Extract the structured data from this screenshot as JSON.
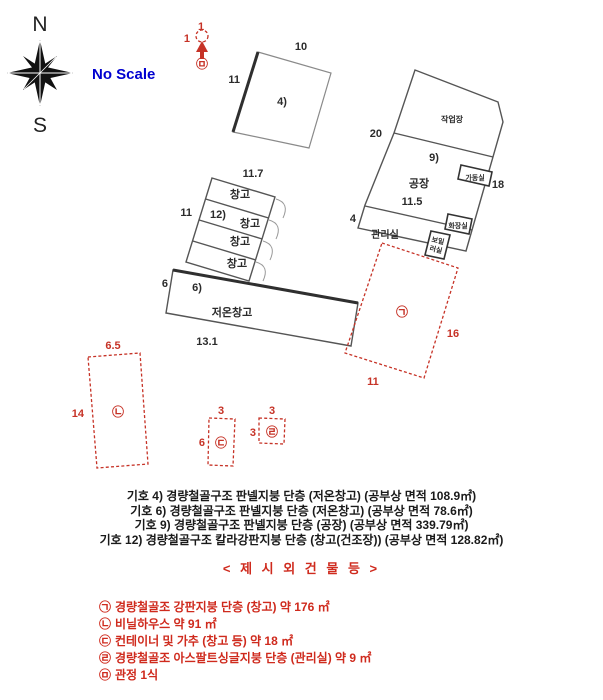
{
  "compass": {
    "north": "N",
    "south": "S"
  },
  "scale_label": "No Scale",
  "colors": {
    "red": "#c63226",
    "blue": "#0000d0",
    "ink": "#2b2b2b"
  },
  "diagram": {
    "building4": {
      "label": "4)",
      "dim_top": "10",
      "dim_left": "11"
    },
    "warehouse_stack": {
      "dim_top": "11.7",
      "dim_left": "11",
      "label": "12)",
      "room1": "창고",
      "room2": "창고",
      "room3": "창고",
      "room4": "창고"
    },
    "cold_storage": {
      "label": "6)",
      "name": "저온창고",
      "dim_left": "6",
      "dim_bottom": "13.1"
    },
    "factory": {
      "label": "9)",
      "name": "공장",
      "workshop_name": "작업장",
      "machine_room": "가동실",
      "office": "관리실",
      "toilet": "화장실",
      "boiler_top": "보일",
      "boiler_bottom": "러실",
      "dim_left": "20",
      "dim_right": "18",
      "dim_width": "11.5",
      "dim_office_left": "4"
    },
    "annex_a": {
      "symbol": "㉠",
      "dim_right": "16",
      "dim_bottom": "11"
    },
    "annex_b": {
      "symbol": "㉡",
      "dim_top": "6.5",
      "dim_left": "14"
    },
    "annex_c": {
      "symbol": "㉢",
      "dim_top": "3",
      "dim_left": "6"
    },
    "annex_d": {
      "symbol": "㉣",
      "dim_top": "3",
      "dim_left": "3"
    },
    "well": {
      "symbol": "㉤",
      "dim_top": "1",
      "dim_left": "1"
    }
  },
  "notes": {
    "line1": "기호 4) 경량철골구조 판넬지붕 단층 (저온창고) (공부상 면적 108.9㎡)",
    "line2": "기호 6) 경량철골구조 판넬지붕 단층 (저온창고) (공부상 면적 78.6㎡)",
    "line3": "기호 9) 경량철골구조 판넬지붕 단층 (공장) (공부상 면적 339.79㎡)",
    "line4": "기호 12) 경량철골구조 칼라강판지붕 단층 (창고(건조장)) (공부상 면적 128.82㎡)"
  },
  "extra_section": {
    "heading": "< 제 시 외 건 물 등 >",
    "items": [
      {
        "symbol": "㉠",
        "text": "경량철골조 강판지붕 단층 (창고) 약 176 ㎡"
      },
      {
        "symbol": "㉡",
        "text": "비닐하우스 약 91 ㎡"
      },
      {
        "symbol": "㉢",
        "text": "컨테이너 및 가추 (창고 등) 약 18 ㎡"
      },
      {
        "symbol": "㉣",
        "text": "경량철골조 아스팔트싱글지붕 단층 (관리실) 약 9 ㎡"
      },
      {
        "symbol": "㉤",
        "text": "관정 1식"
      }
    ]
  }
}
